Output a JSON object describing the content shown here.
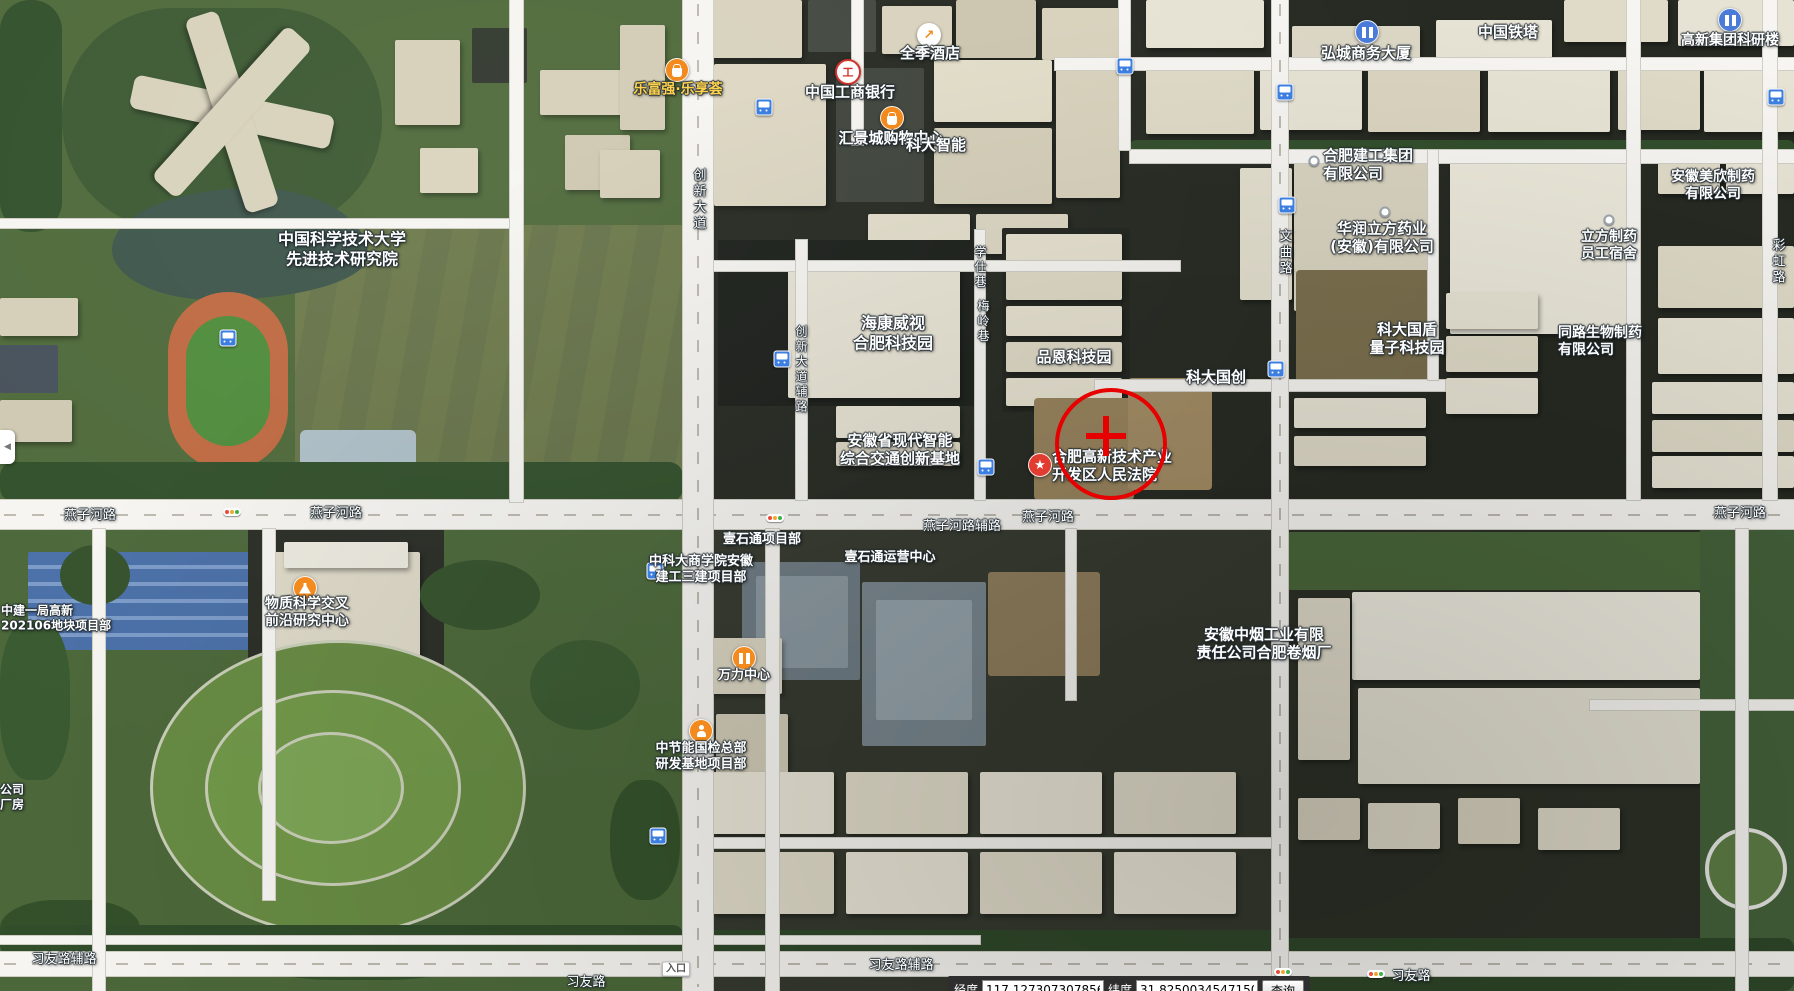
{
  "app": {
    "type": "satellite-map-view"
  },
  "colors": {
    "label_white": "#ffffff",
    "label_yellow": "#ffd24d",
    "annotation_red": "#e60000",
    "poi_orange": "#f28a1d",
    "poi_red": "#e23b30",
    "poi_blue": "#4a7bd8",
    "bus_blue": "#3d7fe0"
  },
  "annotation": {
    "circle": {
      "x": 1107,
      "y": 440,
      "r": 52
    },
    "cross": {
      "x": 1106,
      "y": 436,
      "arm": 40,
      "thickness": 6
    }
  },
  "labels": [
    {
      "name": "poi-ustc-advanced-institute",
      "lines": [
        "中国科学技术大学",
        "先进技术研究院"
      ],
      "x": 342,
      "y": 249,
      "size": 16,
      "type": "poi"
    },
    {
      "name": "poi-lefuqiang-mall",
      "lines": [
        "乐富强·乐享荟"
      ],
      "x": 678,
      "y": 90,
      "size": 14,
      "type": "poi",
      "color": "#ffd24d"
    },
    {
      "name": "poi-quanji-hotel",
      "lines": [
        "全季酒店"
      ],
      "x": 930,
      "y": 53,
      "size": 15,
      "type": "poi"
    },
    {
      "name": "poi-icbc-bank",
      "lines": [
        "中国工商银行"
      ],
      "x": 850,
      "y": 92,
      "size": 15,
      "type": "poi"
    },
    {
      "name": "poi-huijingcheng-mall",
      "lines": [
        "汇景城购物中心"
      ],
      "x": 891,
      "y": 138,
      "size": 15,
      "type": "poi"
    },
    {
      "name": "poi-keda-intelligence",
      "lines": [
        "科大智能"
      ],
      "x": 936,
      "y": 145,
      "size": 15,
      "type": "poi"
    },
    {
      "name": "poi-hongcheng-tower",
      "lines": [
        "弘城商务大厦"
      ],
      "x": 1366,
      "y": 53,
      "size": 15,
      "type": "poi"
    },
    {
      "name": "poi-china-tower",
      "lines": [
        "中国铁塔"
      ],
      "x": 1508,
      "y": 32,
      "size": 15,
      "type": "poi"
    },
    {
      "name": "poi-gaoxin-research-building",
      "lines": [
        "高新集团科研楼"
      ],
      "x": 1730,
      "y": 41,
      "size": 14,
      "type": "poi"
    },
    {
      "name": "poi-hefei-construction-group",
      "lines": [
        "合肥建工集团",
        "有限公司"
      ],
      "x": 1323,
      "y": 165,
      "size": 15,
      "type": "poi",
      "align": "left"
    },
    {
      "name": "poi-huarun-lifang-pharma",
      "lines": [
        "华润立方药业",
        "(安徽)有限公司"
      ],
      "x": 1382,
      "y": 238,
      "size": 15,
      "type": "poi"
    },
    {
      "name": "poi-meixin-pharma",
      "lines": [
        "安徽美欣制药",
        "有限公司"
      ],
      "x": 1713,
      "y": 186,
      "size": 14,
      "type": "poi"
    },
    {
      "name": "poi-lifang-dormitory",
      "lines": [
        "立方制药",
        "员工宿舍"
      ],
      "x": 1609,
      "y": 246,
      "size": 14,
      "type": "poi"
    },
    {
      "name": "poi-hikvision-park",
      "lines": [
        "海康威视",
        "合肥科技园"
      ],
      "x": 893,
      "y": 333,
      "size": 16,
      "type": "poi"
    },
    {
      "name": "poi-pinen-tech-park",
      "lines": [
        "品恩科技园"
      ],
      "x": 1074,
      "y": 357,
      "size": 15,
      "type": "poi"
    },
    {
      "name": "poi-keda-guochuang",
      "lines": [
        "科大国创"
      ],
      "x": 1216,
      "y": 377,
      "size": 15,
      "type": "poi"
    },
    {
      "name": "poi-guodun-quantum-park",
      "lines": [
        "科大国盾",
        "量子科技园"
      ],
      "x": 1407,
      "y": 339,
      "size": 15,
      "type": "poi"
    },
    {
      "name": "poi-tonglu-bio-pharma",
      "lines": [
        "同路生物制药",
        "有限公司"
      ],
      "x": 1558,
      "y": 342,
      "size": 14,
      "type": "poi",
      "align": "left"
    },
    {
      "name": "poi-transport-innovation-base",
      "lines": [
        "安徽省现代智能",
        "综合交通创新基地"
      ],
      "x": 900,
      "y": 450,
      "size": 15,
      "type": "poi"
    },
    {
      "name": "poi-hefei-hightech-court",
      "lines": [
        "合肥高新技术产业",
        "开发区人民法院"
      ],
      "x": 1052,
      "y": 466,
      "size": 15,
      "type": "poi",
      "align": "left"
    },
    {
      "name": "poi-material-science-center",
      "lines": [
        "物质科学交叉",
        "前沿研究中心"
      ],
      "x": 307,
      "y": 613,
      "size": 14,
      "type": "poi"
    },
    {
      "name": "poi-zhongjian-project",
      "lines": [
        "中建一局高新",
        "202106地块项目部"
      ],
      "x": 1,
      "y": 618,
      "size": 12,
      "type": "poi",
      "align": "left"
    },
    {
      "name": "poi-ustc-business-school-project",
      "lines": [
        "中科大商学院安徽",
        "建工三建项目部"
      ],
      "x": 701,
      "y": 570,
      "size": 13,
      "type": "poi"
    },
    {
      "name": "poi-yishitong-project",
      "lines": [
        "壹石通项目部"
      ],
      "x": 762,
      "y": 540,
      "size": 13,
      "type": "poi"
    },
    {
      "name": "poi-yishitong-operations",
      "lines": [
        "壹石通运营中心"
      ],
      "x": 890,
      "y": 558,
      "size": 13,
      "type": "poi"
    },
    {
      "name": "poi-wanli-center",
      "lines": [
        "万力中心"
      ],
      "x": 744,
      "y": 676,
      "size": 13,
      "type": "poi"
    },
    {
      "name": "poi-zhongjieneng-project",
      "lines": [
        "中节能国检总部",
        "研发基地项目部"
      ],
      "x": 701,
      "y": 757,
      "size": 13,
      "type": "poi"
    },
    {
      "name": "poi-anhui-tobacco-factory",
      "lines": [
        "安徽中烟工业有限",
        "责任公司合肥卷烟厂"
      ],
      "x": 1264,
      "y": 644,
      "size": 15,
      "type": "poi"
    },
    {
      "name": "poi-clipped-company",
      "lines": [
        "公司",
        "厂房"
      ],
      "x": 0,
      "y": 797,
      "size": 12,
      "type": "poi",
      "align": "left"
    },
    {
      "name": "road-yanzihe-1",
      "lines": [
        "燕子河路"
      ],
      "x": 90,
      "y": 516,
      "size": 13,
      "type": "road"
    },
    {
      "name": "road-yanzihe-2",
      "lines": [
        "燕子河路"
      ],
      "x": 336,
      "y": 514,
      "size": 13,
      "type": "road"
    },
    {
      "name": "road-yanzihe-3",
      "lines": [
        "燕子河路"
      ],
      "x": 1048,
      "y": 518,
      "size": 13,
      "type": "road"
    },
    {
      "name": "road-yanzihe-4",
      "lines": [
        "燕子河路"
      ],
      "x": 1740,
      "y": 514,
      "size": 13,
      "type": "road"
    },
    {
      "name": "road-yanzihe-service",
      "lines": [
        "燕子河路辅路"
      ],
      "x": 962,
      "y": 527,
      "size": 13,
      "type": "road"
    },
    {
      "name": "road-xiyou-service-1",
      "lines": [
        "习友路辅路"
      ],
      "x": 64,
      "y": 960,
      "size": 13,
      "type": "road"
    },
    {
      "name": "road-xiyou-service-2",
      "lines": [
        "习友路辅路"
      ],
      "x": 901,
      "y": 966,
      "size": 13,
      "type": "road"
    },
    {
      "name": "road-xiyou-1",
      "lines": [
        "习友路"
      ],
      "x": 586,
      "y": 983,
      "size": 13,
      "type": "road"
    },
    {
      "name": "road-xiyou-2",
      "lines": [
        "习友路"
      ],
      "x": 1411,
      "y": 977,
      "size": 13,
      "type": "road"
    },
    {
      "name": "road-chuangxin-avenue",
      "lines": [
        "创新大道"
      ],
      "x": 698,
      "y": 200,
      "size": 13,
      "type": "vroad"
    },
    {
      "name": "road-chuangxin-service",
      "lines": [
        "创新大道辅路"
      ],
      "x": 801,
      "y": 370,
      "size": 12,
      "type": "vroad"
    },
    {
      "name": "road-xueshi-lane",
      "lines": [
        "学仕巷"
      ],
      "x": 980,
      "y": 268,
      "size": 12,
      "type": "vroad"
    },
    {
      "name": "road-meiling-lane",
      "lines": [
        "梅岭巷"
      ],
      "x": 983,
      "y": 322,
      "size": 12,
      "type": "vroad"
    },
    {
      "name": "road-wenqu",
      "lines": [
        "文曲路"
      ],
      "x": 1284,
      "y": 253,
      "size": 13,
      "type": "vroad"
    },
    {
      "name": "road-caihong",
      "lines": [
        "彩虹路"
      ],
      "x": 1777,
      "y": 262,
      "size": 13,
      "type": "vroad"
    },
    {
      "name": "entrance-badge",
      "lines": [
        "入口"
      ],
      "x": 676,
      "y": 969,
      "size": 10,
      "type": "badge"
    }
  ],
  "icons": [
    {
      "name": "bus-stop-icon",
      "type": "bus",
      "x": 764,
      "y": 107
    },
    {
      "name": "bus-stop-icon",
      "type": "bus",
      "x": 1125,
      "y": 66
    },
    {
      "name": "bus-stop-icon",
      "type": "bus",
      "x": 1285,
      "y": 92
    },
    {
      "name": "bus-stop-icon",
      "type": "bus",
      "x": 1287,
      "y": 205
    },
    {
      "name": "bus-stop-icon",
      "type": "bus",
      "x": 1276,
      "y": 369
    },
    {
      "name": "bus-stop-icon",
      "type": "bus",
      "x": 782,
      "y": 359
    },
    {
      "name": "bus-stop-icon",
      "type": "bus",
      "x": 986,
      "y": 467
    },
    {
      "name": "bus-stop-icon",
      "type": "bus",
      "x": 655,
      "y": 571
    },
    {
      "name": "bus-stop-icon",
      "type": "bus",
      "x": 658,
      "y": 836
    },
    {
      "name": "bus-stop-icon",
      "type": "bus",
      "x": 228,
      "y": 338
    },
    {
      "name": "bus-stop-icon",
      "type": "bus",
      "x": 1776,
      "y": 97
    },
    {
      "name": "traffic-light-icon",
      "type": "traffic",
      "x": 232,
      "y": 512
    },
    {
      "name": "traffic-light-icon",
      "type": "traffic",
      "x": 775,
      "y": 518
    },
    {
      "name": "traffic-light-icon",
      "type": "traffic",
      "x": 1283,
      "y": 972
    },
    {
      "name": "traffic-light-icon",
      "type": "traffic",
      "x": 1376,
      "y": 974
    },
    {
      "name": "hotel-poi-icon",
      "type": "hotel",
      "x": 929,
      "y": 35
    },
    {
      "name": "bank-poi-icon",
      "type": "bank",
      "x": 848,
      "y": 72
    },
    {
      "name": "mall-poi-icon",
      "type": "bag",
      "x": 892,
      "y": 118
    },
    {
      "name": "shop-poi-icon",
      "type": "bag",
      "x": 677,
      "y": 70
    },
    {
      "name": "research-poi-icon",
      "type": "flask",
      "x": 305,
      "y": 588
    },
    {
      "name": "court-poi-icon",
      "type": "star",
      "x": 1040,
      "y": 465
    },
    {
      "name": "office-poi-icon",
      "type": "office",
      "x": 1367,
      "y": 32
    },
    {
      "name": "office-poi-icon",
      "type": "office",
      "x": 1730,
      "y": 20
    },
    {
      "name": "company-poi-icon",
      "type": "office-orange",
      "x": 744,
      "y": 658
    },
    {
      "name": "project-poi-icon",
      "type": "person",
      "x": 701,
      "y": 731
    },
    {
      "name": "poi-dot-icon",
      "type": "dot",
      "x": 1314,
      "y": 161
    },
    {
      "name": "poi-dot-icon",
      "type": "dot",
      "x": 1385,
      "y": 212
    },
    {
      "name": "poi-dot-icon",
      "type": "dot",
      "x": 1609,
      "y": 220
    }
  ],
  "bottom_bar": {
    "lon_label": "经度",
    "lon_value": "117.1273073078567",
    "lat_label": "纬度",
    "lat_value": "31.82500345471504",
    "search_button": "查询"
  },
  "collapse_tab": {
    "icon": "left-arrow"
  }
}
